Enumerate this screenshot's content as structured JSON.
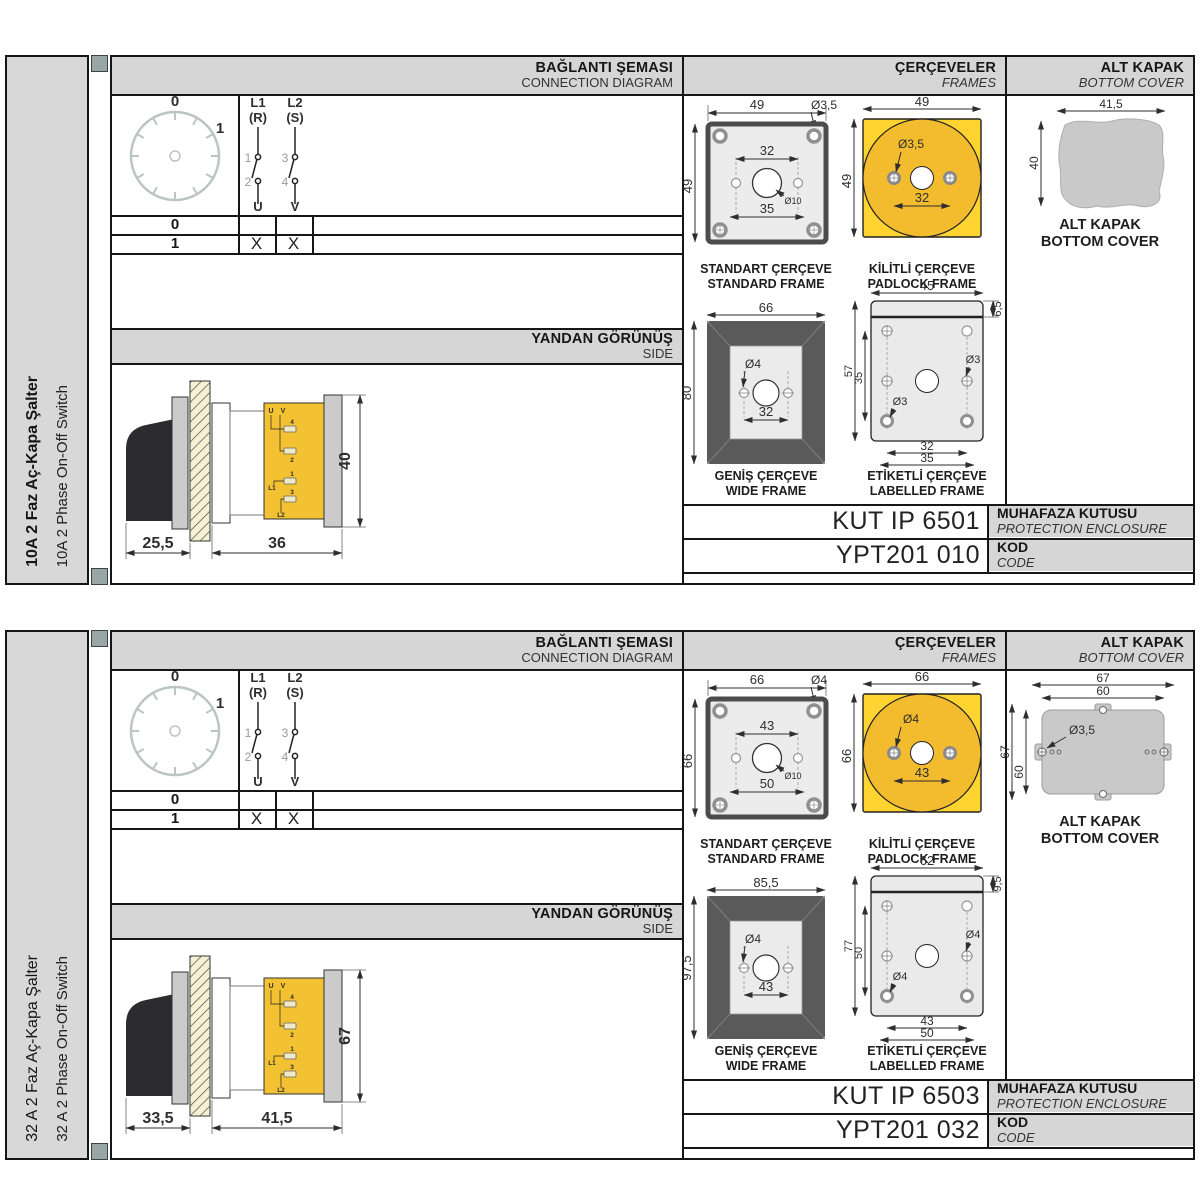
{
  "colors": {
    "panel_gray": "#d6d6d6",
    "yellow": "#ffd431",
    "yellow_dark": "#f3bb2e",
    "frame_fill": "#ececec",
    "cover_gray": "#c9c9c9",
    "border": "#161616"
  },
  "labels": {
    "connection_title": "BAĞLANTI ŞEMASI",
    "connection_subtitle": "CONNECTION DIAGRAM",
    "frames_title": "ÇERÇEVELER",
    "frames_subtitle": "FRAMES",
    "cover_title": "ALT KAPAK",
    "cover_subtitle": "BOTTOM COVER",
    "side_title": "YANDAN GÖRÜNÜŞ",
    "side_subtitle": "SIDE",
    "standard_frame_tr": "STANDART ÇERÇEVE",
    "standard_frame_en": "STANDARD FRAME",
    "padlock_frame_tr": "KİLİTLİ ÇERÇEVE",
    "padlock_frame_en": "PADLOCK FRAME",
    "wide_frame_tr": "GENİŞ ÇERÇEVE",
    "wide_frame_en": "WIDE FRAME",
    "labelled_frame_tr": "ETİKETLİ ÇERÇEVE",
    "labelled_frame_en": "LABELLED FRAME",
    "cover_caption_tr": "ALT KAPAK",
    "cover_caption_en": "BOTTOM COVER",
    "enclosure_tr": "MUHAFAZA KUTUSU",
    "enclosure_en": "PROTECTION ENCLOSURE",
    "code_tr": "KOD",
    "code_en": "CODE",
    "dial": {
      "pos0": "0",
      "pos1": "1"
    },
    "poles": {
      "p1a": "L1",
      "p1b": "(R)",
      "p2a": "L2",
      "p2b": "(S)",
      "c1": "1",
      "c2": "2",
      "c3": "3",
      "c4": "4",
      "u": "U",
      "v": "V"
    },
    "table": {
      "row0": "0",
      "row1": "1",
      "x": "X"
    },
    "terminals": {
      "u": "U",
      "v": "V",
      "n1": "1",
      "n2": "2",
      "n3": "3",
      "n4": "4",
      "l1": "L1",
      "l2": "L2"
    }
  },
  "sections": [
    {
      "title_tr": "10A 2 Faz Aç-Kapa Şalter",
      "title_en": "10A 2 Phase On-Off Switch",
      "standard_frame": {
        "width": "49",
        "height": "49",
        "hole": "Ø3,5",
        "pitch": "32",
        "pitch2": "35",
        "center_hole": "Ø10"
      },
      "padlock_frame": {
        "width": "49",
        "height": "49",
        "hole": "Ø3,5",
        "pitch": "32"
      },
      "wide_frame": {
        "width": "66",
        "height": "80",
        "hole": "Ø4",
        "pitch": "32"
      },
      "labelled_frame": {
        "width": "45",
        "strip": "6,5",
        "height": "57",
        "inner_height": "35",
        "hole1": "Ø3",
        "hole2": "Ø3",
        "pitch": "32",
        "pitch2": "35"
      },
      "bottom_cover": {
        "width": "41,5",
        "height": "40"
      },
      "side_view": {
        "front_depth": "25,5",
        "body_depth": "36",
        "height": "40"
      },
      "enclosure_code": "KUT IP 6501",
      "order_code": "YPT201 010"
    },
    {
      "title_tr": "32 A 2 Faz Aç-Kapa Şalter",
      "title_en": "32 A 2 Phase On-Off Switch",
      "standard_frame": {
        "width": "66",
        "height": "66",
        "hole": "Ø4",
        "pitch": "43",
        "pitch2": "50",
        "center_hole": "Ø10"
      },
      "padlock_frame": {
        "width": "66",
        "height": "66",
        "hole": "Ø4",
        "pitch": "43"
      },
      "wide_frame": {
        "width": "85,5",
        "height": "97,5",
        "hole": "Ø4",
        "pitch": "43"
      },
      "labelled_frame": {
        "width": "62",
        "strip": "9,5",
        "height": "77",
        "inner_height": "50",
        "hole1": "Ø4",
        "hole2": "Ø4",
        "pitch": "43",
        "pitch2": "50"
      },
      "bottom_cover": {
        "outer_width": "67",
        "inner_width": "60",
        "outer_height": "67",
        "inner_height": "60",
        "hole": "Ø3,5"
      },
      "side_view": {
        "front_depth": "33,5",
        "body_depth": "41,5",
        "height": "67"
      },
      "enclosure_code": "KUT IP 6503",
      "order_code": "YPT201 032"
    }
  ]
}
